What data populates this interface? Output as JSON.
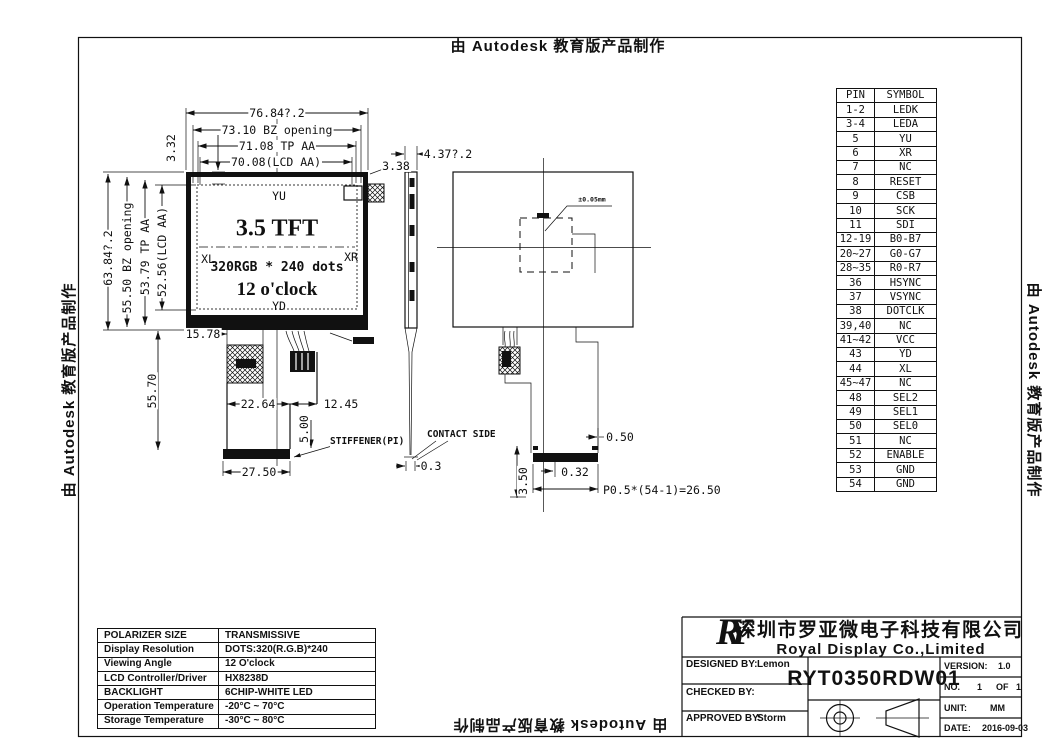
{
  "watermark": {
    "text": "由 Autodesk 教育版产品制作"
  },
  "front_view": {
    "title": "3.5 TFT",
    "subtitle": "320RGB * 240 dots",
    "clock": "12 o'clock",
    "electrode_top": "YU",
    "electrode_bottom": "YD",
    "electrode_left": "XL",
    "electrode_right": "XR",
    "dims": {
      "overall_width": "76.84?.2",
      "bz_opening_w": "73.10 BZ opening",
      "tp_aa_w": "71.08 TP AA",
      "lcd_aa_w": "70.08(LCD AA)",
      "top_margin": "3.32",
      "right_margin": "3.38",
      "overall_height": "63.84?.2",
      "bz_opening_h": "55.50 BZ opening",
      "tp_aa_h": "53.79 TP AA",
      "lcd_aa_h": "52.56(LCD AA)",
      "fpc_offset": "15.78",
      "fpc_length": "55.70",
      "stiffener_offset": "22.64",
      "fpc_width": "12.45",
      "stiffener_height": "5.00",
      "stiffener_label": "STIFFENER(PI)",
      "stiffener_width": "27.50"
    }
  },
  "side_view": {
    "thickness": "4.37?.2",
    "tail_thickness": "0.3",
    "contact_side": "CONTACT SIDE"
  },
  "back_view": {
    "annotation": "±0.05mm",
    "pad_end": "0.50",
    "pad_offset": "0.32",
    "pad_height": "3.50",
    "pitch": "P0.5*(54-1)=26.50"
  },
  "pin_table": {
    "headers": [
      "PIN",
      "SYMBOL"
    ],
    "rows": [
      [
        "1-2",
        "LEDK"
      ],
      [
        "3-4",
        "LEDA"
      ],
      [
        "5",
        "YU"
      ],
      [
        "6",
        "XR"
      ],
      [
        "7",
        "NC"
      ],
      [
        "8",
        "RESET"
      ],
      [
        "9",
        "CSB"
      ],
      [
        "10",
        "SCK"
      ],
      [
        "11",
        "SDI"
      ],
      [
        "12-19",
        "B0-B7"
      ],
      [
        "20~27",
        "G0-G7"
      ],
      [
        "28~35",
        "R0-R7"
      ],
      [
        "36",
        "HSYNC"
      ],
      [
        "37",
        "VSYNC"
      ],
      [
        "38",
        "DOTCLK"
      ],
      [
        "39,40",
        "NC"
      ],
      [
        "41~42",
        "VCC"
      ],
      [
        "43",
        "YD"
      ],
      [
        "44",
        "XL"
      ],
      [
        "45~47",
        "NC"
      ],
      [
        "48",
        "SEL2"
      ],
      [
        "49",
        "SEL1"
      ],
      [
        "50",
        "SEL0"
      ],
      [
        "51",
        "NC"
      ],
      [
        "52",
        "ENABLE"
      ],
      [
        "53",
        "GND"
      ],
      [
        "54",
        "GND"
      ]
    ]
  },
  "spec_table": {
    "rows": [
      [
        "POLARIZER SIZE",
        "TRANSMISSIVE"
      ],
      [
        "Display Resolution",
        "DOTS:320(R.G.B)*240"
      ],
      [
        "Viewing Angle",
        "12 O'clock"
      ],
      [
        "LCD Controller/Driver",
        "HX8238D"
      ],
      [
        "BACKLIGHT",
        "6CHIP-WHITE LED"
      ],
      [
        "Operation Temperature",
        "-20°C ~ 70°C"
      ],
      [
        "Storage Temperature",
        "-30°C ~ 80°C"
      ]
    ]
  },
  "title_block": {
    "logo": "RY",
    "company_cn": "深圳市罗亚微电子科技有限公司",
    "company_en": "Royal Display Co.,Limited",
    "designed_by_label": "DESIGNED BY:",
    "designed_by": "Lemon",
    "checked_by_label": "CHECKED BY:",
    "checked_by": "",
    "approved_by_label": "APPROVED BY:",
    "approved_by": "Storm",
    "part_number": "RYT0350RDW01",
    "version_label": "VERSION:",
    "version": "1.0",
    "no_label": "NO.",
    "no_value": "1",
    "of_label": "OF",
    "of_value": "1",
    "unit_label": "UNIT:",
    "unit": "MM",
    "date_label": "DATE:",
    "date": "2016-09-03"
  }
}
